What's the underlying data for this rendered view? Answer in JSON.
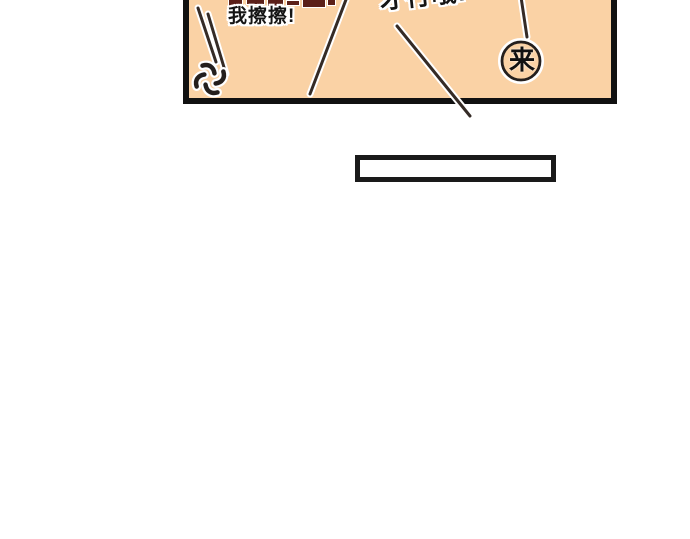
{
  "comic": {
    "panel": {
      "background_color": "#FAD2A5",
      "border_color": "#111111",
      "shout_left": "我擦擦!",
      "shout_right_partial": "才行哦!",
      "balloon_char": "来"
    },
    "caption_box": {
      "text": "",
      "border_color": "#1A1A1A",
      "fill_color": "#FFFFFF"
    },
    "colors": {
      "page_background": "#FFFFFF",
      "motion_line": "#352B26",
      "glow": "#FFFFFF",
      "anger_mark": "#241F1D",
      "cropped_text_fragment": "#5B1F18"
    },
    "decorations": {
      "anger_mark": "anger-vein-icon",
      "motion_line_count": 5,
      "cropped_text_note": "top row of larger dark-red speech text cut off by image edge"
    }
  }
}
